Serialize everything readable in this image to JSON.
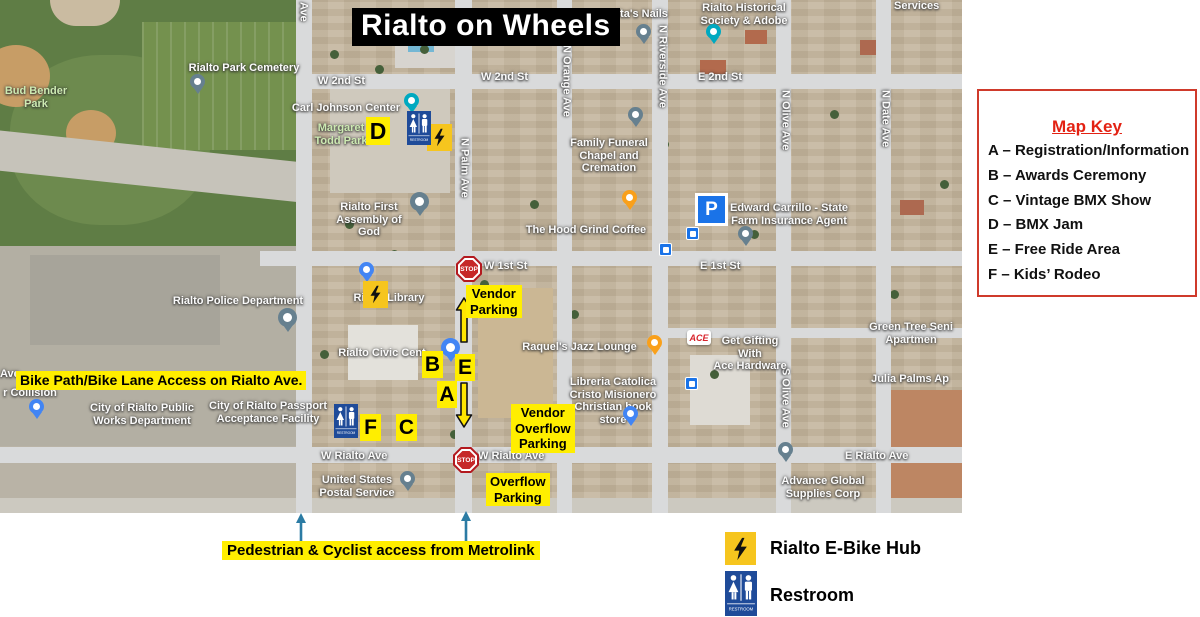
{
  "title": "Rialto on Wheels",
  "map_key": {
    "title": "Map Key",
    "entries": [
      "A – Registration/Information",
      "B – Awards Ceremony",
      "C – Vintage BMX Show",
      "D – BMX Jam",
      "E – Free Ride Area",
      "F – Kids’ Rodeo"
    ]
  },
  "markers": {
    "a": "A",
    "b": "B",
    "c": "C",
    "d": "D",
    "e": "E",
    "f": "F"
  },
  "annotations": {
    "vendor_parking": "Vendor\nParking",
    "vendor_overflow_parking": "Vendor\nOverflow\nParking",
    "overflow_parking": "Overflow\nParking",
    "bike_path": "Bike Path/Bike Lane Access on Rialto Ave.",
    "pedestrian_access": "Pedestrian & Cyclist access from Metrolink"
  },
  "legend": {
    "ebike_label": "Rialto E-Bike Hub",
    "restroom_label": "Restroom"
  },
  "icons": {
    "stop_sign": "STOP",
    "parking_letter": "P",
    "restroom_sign": "RESTROOM",
    "ace_logo": "ACE"
  },
  "streets": {
    "w_2nd_left": "W 2nd St",
    "w_2nd": "W 2nd St",
    "e_2nd": "E 2nd St",
    "w_1st": "W 1st St",
    "e_1st": "E 1st St",
    "w_rialto_left": "W Rialto Ave",
    "w_rialto": "W Rialto Ave",
    "e_rialto": "E Rialto Ave",
    "n_palm": "N Palm Ave",
    "n_orange": "N Orange Ave",
    "n_riverside": "N Riverside Ave",
    "n_olive": "N Olive Ave",
    "s_olive": "S Olive Ave",
    "n_date": "N Date Ave",
    "ave_fragment_top": "Ave",
    "ave_fragment_left": "Ave"
  },
  "places": {
    "bud_bender": "Bud Bender\nPark",
    "cemetery": "Rialto Park Cemetery",
    "carl_johnson": "Carl Johnson Center",
    "margaret_todd": "Margaret\nTodd Park",
    "nails": "orita's Nails",
    "historical": "Rialto Historical\nSociety & Adobe",
    "services": "Services",
    "family_funeral": "Family Funeral\nChapel and Cremation",
    "assembly": "Rialto First\nAssembly of God",
    "hood_grind": "The Hood Grind Coffee",
    "state_farm": "Edward Carrillo - State\nFarm Insurance Agent",
    "police": "Rialto Police Department",
    "library": "Rialto Library",
    "civic_center": "Rialto Civic Cent",
    "jazz_lounge": "Raquel's Jazz Lounge",
    "ace_hardware": "Get Gifting With\nAce Hardware",
    "green_tree": "Green Tree Seni\nApartmen",
    "julia_palms": "Julia Palms Ap",
    "libreria": "Libreria Catolica\nCristo Misionero\nChristian book store",
    "collision": "r Collision",
    "public_works": "City of Rialto Public\nWorks Department",
    "passport": "City of Rialto Passport\nAcceptance Facility",
    "postal": "United States\nPostal Service",
    "advance_global": "Advance Global\nSupplies Corp"
  }
}
